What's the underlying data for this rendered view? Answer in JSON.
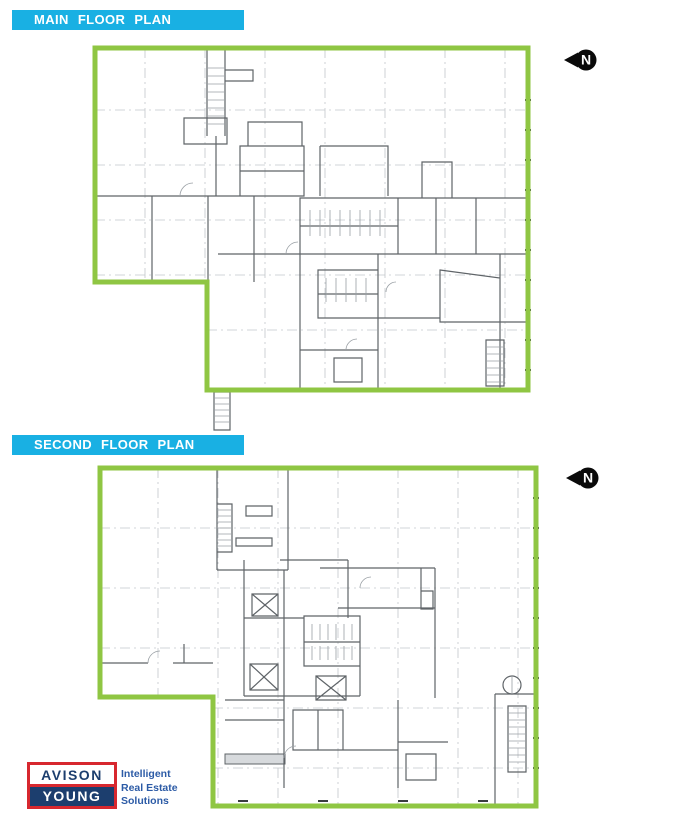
{
  "page": {
    "background": "#ffffff"
  },
  "colors": {
    "banner_cyan": "#19b0e3",
    "outline_green": "#8fc643",
    "wall_gray": "#5f6468",
    "grid_gray": "#c3c7cb",
    "logo_navy": "#1c3e6e",
    "logo_red": "#d7282f",
    "tagline_blue": "#2c5ba6",
    "north_black": "#0a0a0a"
  },
  "sections": [
    {
      "id": "main-floor",
      "title": "MAIN FLOOR PLAN"
    },
    {
      "id": "second-floor",
      "title": "SECOND FLOOR PLAN"
    }
  ],
  "north_arrow": {
    "label": "N"
  },
  "plans": {
    "main": {
      "name": "Main Floor Plan",
      "outline_points": "7,8 440,8 440,350 119,350 119,242 7,242"
    },
    "second": {
      "name": "Second Floor Plan",
      "outline_points": "12,10 448,10 448,348 125,348 125,239 12,239"
    }
  },
  "logo": {
    "top": "AVISON",
    "bottom": "YOUNG",
    "tagline": [
      "Intelligent",
      "Real Estate",
      "Solutions"
    ]
  }
}
